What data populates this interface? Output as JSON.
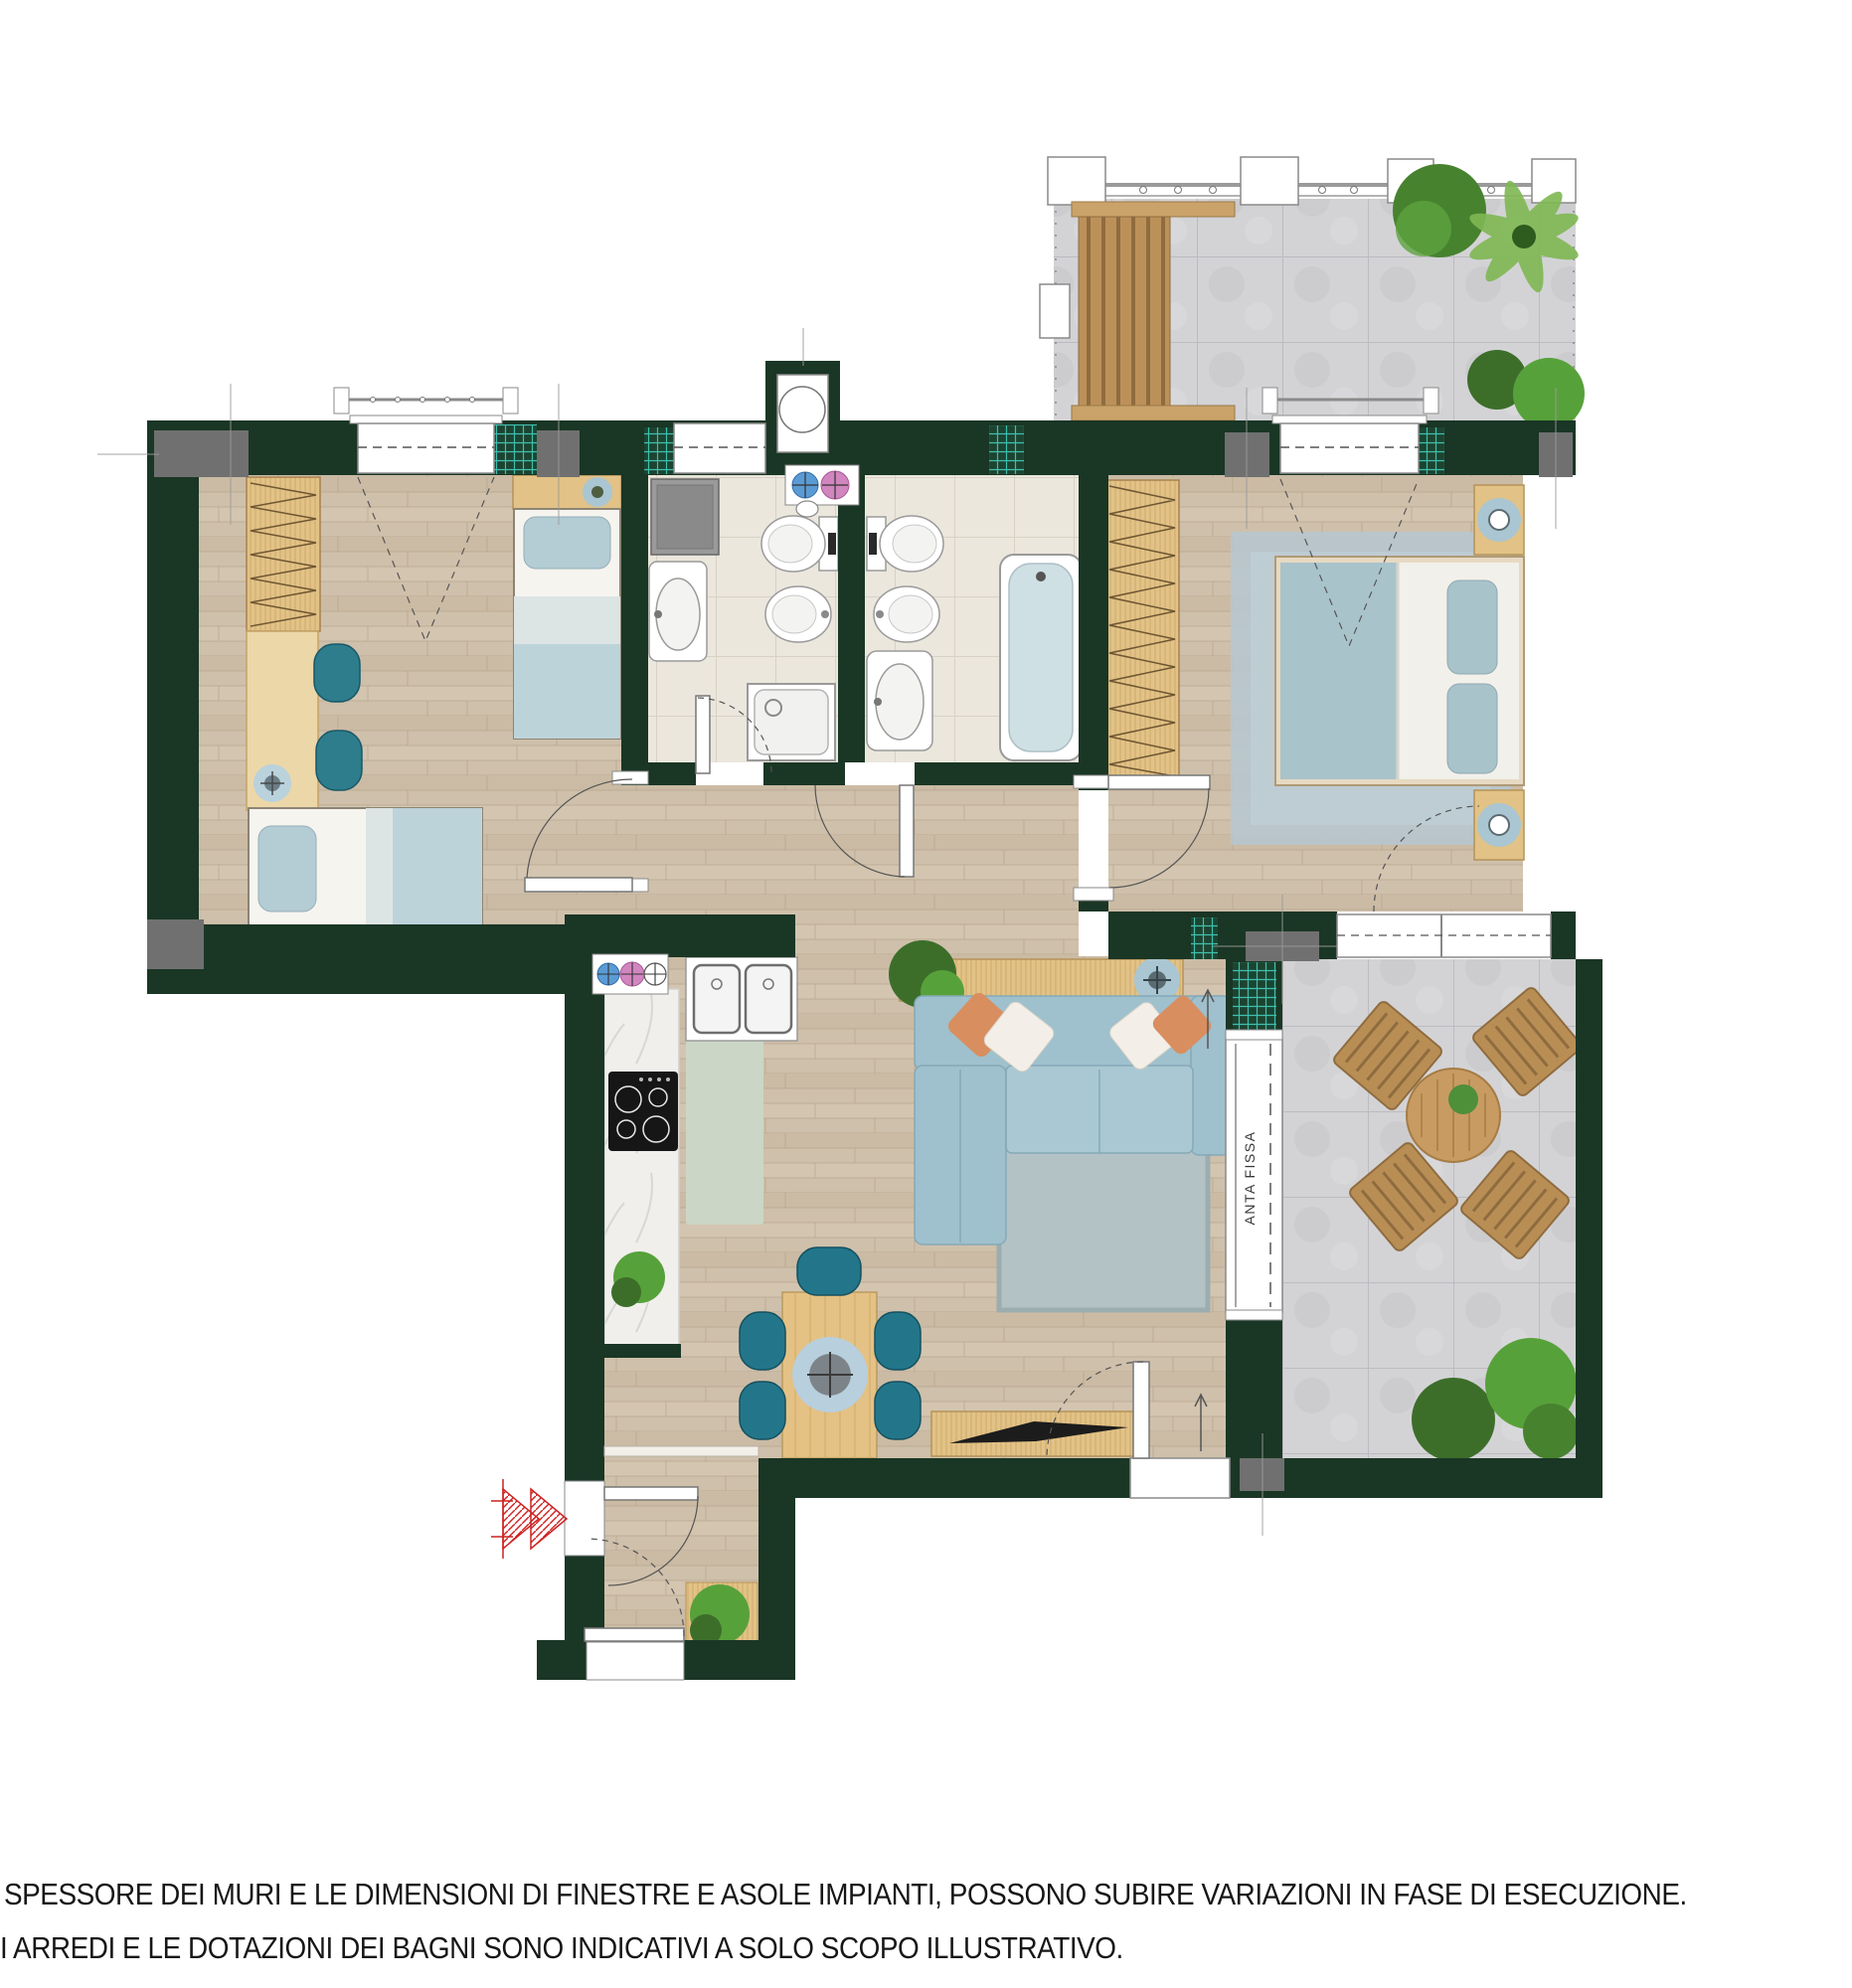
{
  "document": {
    "type": "apartment-floor-plan",
    "labels": {
      "sliding_door": "ANTA FISSA"
    },
    "disclaimer": {
      "line1": "SPESSORE DEI MURI E LE DIMENSIONI DI FINESTRE E ASOLE IMPIANTI, POSSONO SUBIRE VARIAZIONI IN FASE DI ESECUZIONE.",
      "line2": "I ARREDI E LE DOTAZIONI DEI BAGNI SONO INDICATIVI A SOLO SCOPO ILLUSTRATIVO."
    }
  },
  "rooms": [
    {
      "name": "bedroom-2",
      "furniture": [
        "wardrobe",
        "desk",
        "desk-chairs",
        "single-bed-1",
        "single-bed-2"
      ]
    },
    {
      "name": "bathroom-1",
      "furniture": [
        "washing-machine",
        "sink",
        "shower",
        "toilet",
        "bidet"
      ]
    },
    {
      "name": "bathroom-2",
      "furniture": [
        "toilet",
        "bidet",
        "sink",
        "bathtub"
      ]
    },
    {
      "name": "master-bedroom",
      "furniture": [
        "wardrobe",
        "double-bed",
        "nightstands",
        "rug"
      ]
    },
    {
      "name": "living-dining",
      "furniture": [
        "sofa",
        "console",
        "rug",
        "dining-table",
        "chairs",
        "tv-sideboard"
      ]
    },
    {
      "name": "kitchen",
      "furniture": [
        "counter",
        "cooktop",
        "double-sink",
        "runner-rug"
      ]
    },
    {
      "name": "entrance-hall",
      "furniture": [
        "plant-console"
      ]
    },
    {
      "name": "terrace-top",
      "furniture": [
        "pergola",
        "railing",
        "plants"
      ]
    },
    {
      "name": "terrace-right",
      "furniture": [
        "outdoor-table",
        "outdoor-chairs",
        "plants"
      ]
    }
  ],
  "symbols": {
    "risers": [
      "cold-water-riser",
      "hot-water-riser",
      "drain"
    ],
    "boiler_niche": "water-heater",
    "entrance": "entry-arrow"
  },
  "colors": {
    "wall": "#1a3625",
    "wood_floor": "#cfc0ab",
    "bath_tile": "#ebe7dd",
    "terrace_tile": "#d3d3d6",
    "furniture_wood": "#e2c286",
    "outdoor_wood": "#b98e55",
    "sofa_blue": "#9fc0cd",
    "chair_teal": "#23768a",
    "bed_blue": "#b4ccd4",
    "rug_gray": "#b3c2c4",
    "master_rug": "#b7c6cf",
    "marble": "#f0efec",
    "hatch_teal": "#37b3a6",
    "pillar_gray": "#707070",
    "entrance_arrow_red": "#cc2222",
    "riser_blue": "#5b9bd5",
    "riser_pink": "#d186c0",
    "plant_green": "#4e8f3a",
    "pillow_orange": "#d98e5f"
  }
}
